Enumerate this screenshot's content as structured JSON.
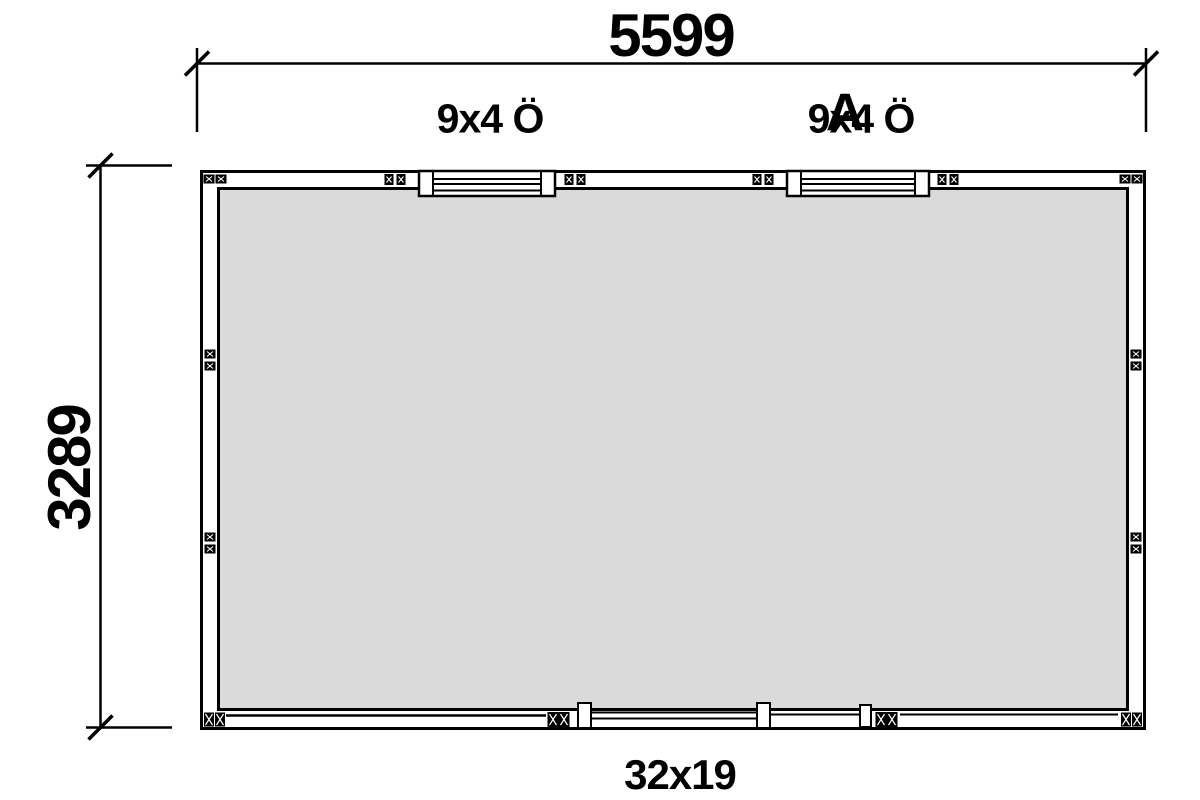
{
  "drawing": {
    "type": "floor-plan",
    "dim_width_label": "5599",
    "dim_height_label": "3289",
    "bottom_label": "32x19",
    "window_label_1": "9x4 Ö",
    "window_label_2": "9x4 Ö",
    "section_marker": "A",
    "colors": {
      "line": "#000000",
      "floor_fill": "#dadada",
      "background": "#ffffff"
    }
  }
}
